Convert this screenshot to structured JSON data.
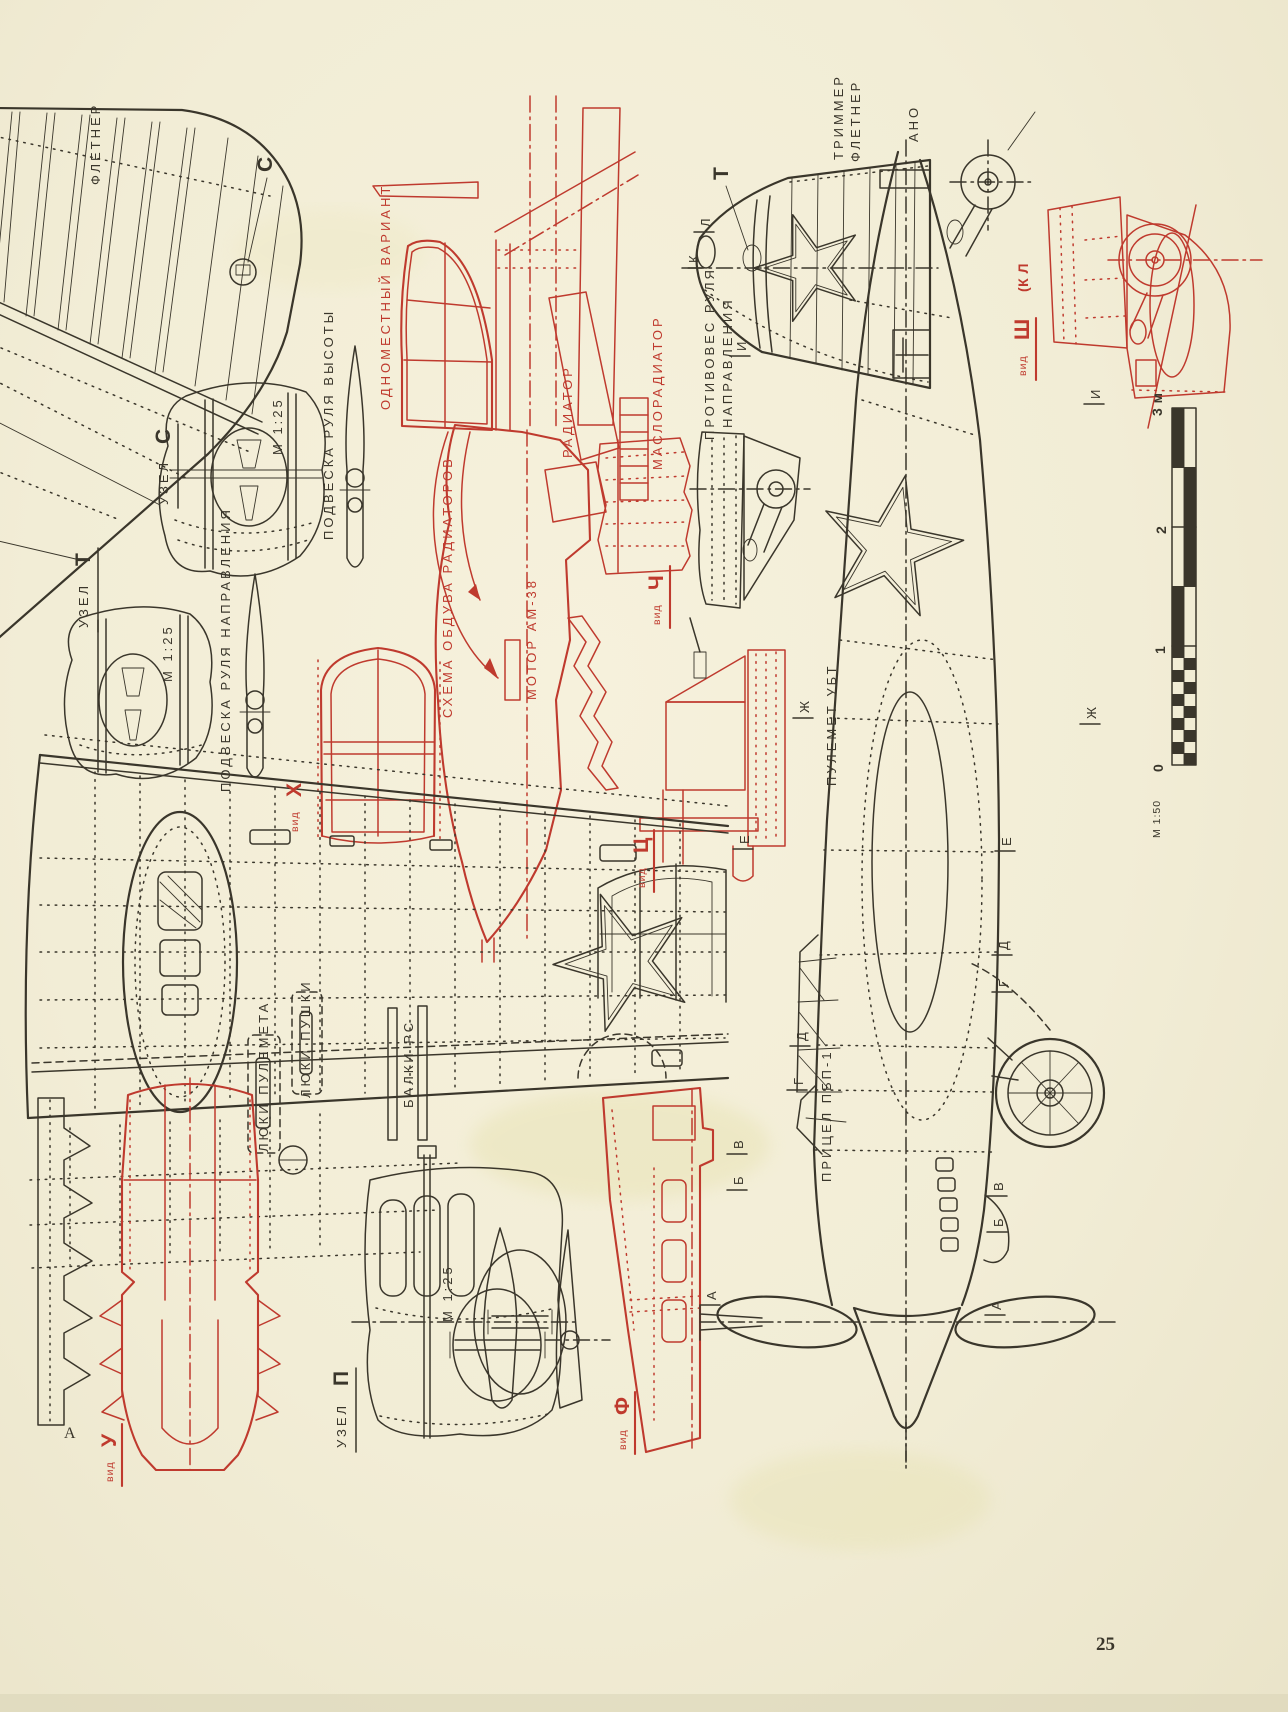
{
  "page": {
    "number": "25",
    "corner_mark": "А"
  },
  "palette": {
    "paper": "#f2edd6",
    "ink": "#3a362b",
    "red": "#bf3a2e"
  },
  "labels": {
    "fletner": "ФЛЕТНЕР",
    "callout_c": "С",
    "callout_t": "Т",
    "node_c": {
      "word": "УЗЕЛ",
      "letter": "С",
      "scale": "М 1:25"
    },
    "node_t": {
      "word": "УЗЕЛ",
      "letter": "Т",
      "scale": "М 1:25"
    },
    "node_p": {
      "word": "УЗЕЛ",
      "letter": "П",
      "scale": "М 1:25"
    },
    "elevator_hinge": "ПОДВЕСКА РУЛЯ ВЫСОТЫ",
    "rudder_hinge": "ПОДВЕСКА РУЛЯ НАПРАВЛЕНИЯ",
    "single_seat": "ОДНОМЕСТНЫЙ ВАРИАНТ",
    "radiator": "РАДИАТОР",
    "oil_cooler": "МАСЛОРАДИАТОР",
    "cooling_scheme": "СХЕМА ОБДУВА РАДИАТОРОВ",
    "engine": "МОТОР АМ-38",
    "counterweight_line1": "ПРОТИВОВЕС РУЛЯ",
    "counterweight_line2": "НАПРАВЛЕНИЯ",
    "trimmer_line1": "ТРИММЕР",
    "trimmer_line2": "ФЛЕТНЕР",
    "nav_light": "АНО",
    "machine_gun": "ПУЛЕМЕТ УБТ",
    "gun_sight": "ПРИЦЕЛ ПБП-1",
    "mg_hatches": "ЛЮКИ ПУЛЕМЕТА",
    "cannon_hatches": "ЛЮКИ ПУШКИ",
    "rocket_rails": "БАЛКИ РС",
    "views": {
      "prefix": "вид",
      "ch": "Ч",
      "ts": "Ц",
      "x": "X",
      "u": "У",
      "f": "Ф",
      "sh": "Ш",
      "sh_suffix": "(К Л"
    }
  },
  "scale_bar": {
    "tick0": "0",
    "tick1": "1",
    "tick2": "2",
    "tick3": "3 м",
    "ratio": "М 1:50"
  },
  "marks": [
    "А",
    "А",
    "Б",
    "В",
    "Б",
    "В",
    "Г",
    "Д",
    "Г",
    "Д",
    "Е",
    "Е",
    "Ж",
    "Ж",
    "И",
    "И",
    "К",
    "Л"
  ]
}
